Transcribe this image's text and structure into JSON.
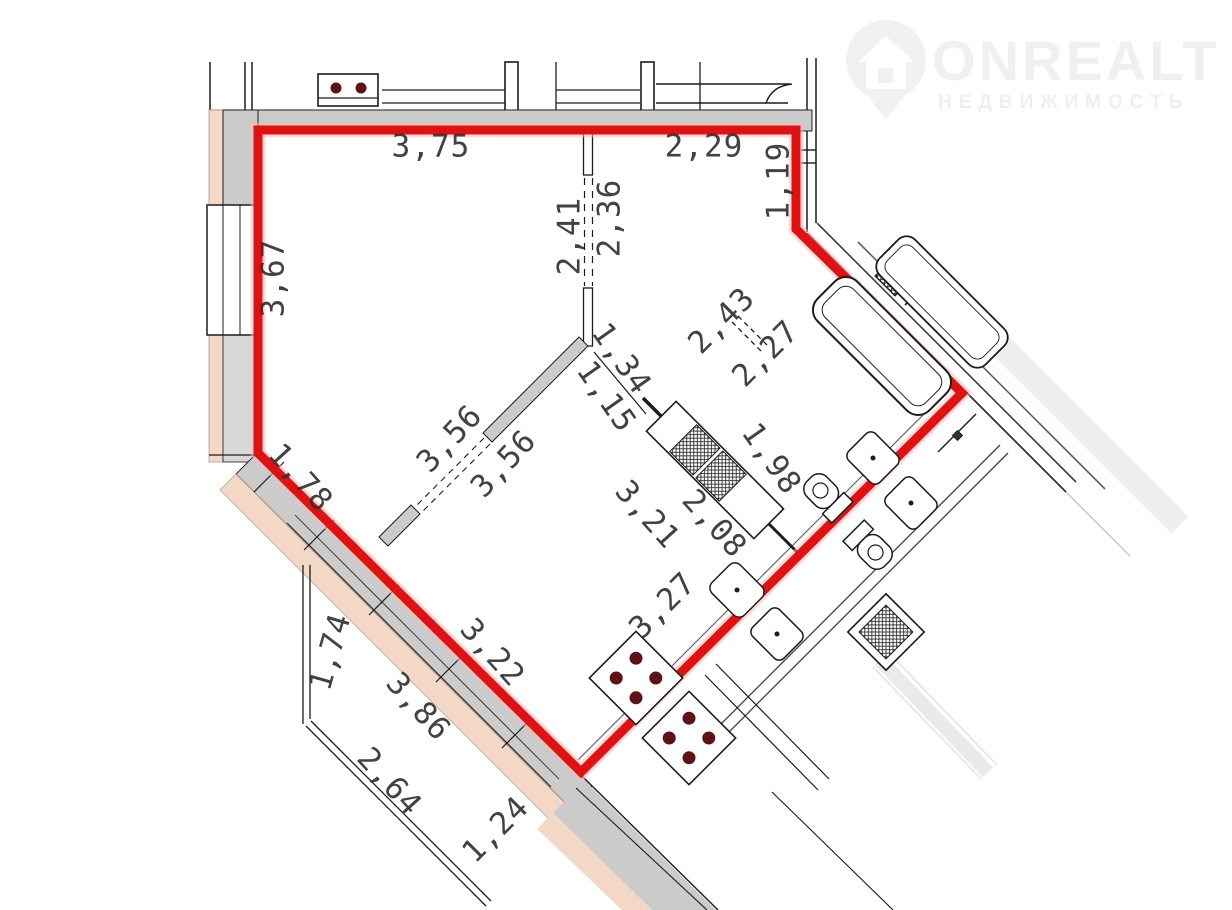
{
  "watermark": {
    "icon": "house-pin-icon",
    "brand": "ONREALT",
    "tagline": "НЕДВИЖИМОСТЬ"
  },
  "plan": {
    "type": "apartment-floor-plan",
    "unit_outline_color": "#e11111",
    "wall_fill_color": "#cbcbcb",
    "facade_fill_color": "#f3d8c6",
    "dimension_text_color": "#2e2e2e",
    "fixture_icons": {
      "bathtub-icon": "rounded rectangle",
      "toilet-icon": "bowl with tank",
      "sink-icon": "rounded square with dot",
      "stove-icon": "square with 4 burner dots",
      "vent-icon": "crosshatched square",
      "washing-machine-icon": "hatched square"
    },
    "dimensions": [
      {
        "id": "top-room-width",
        "value": "3,75"
      },
      {
        "id": "top-hall-width",
        "value": "2,29"
      },
      {
        "id": "right-niche",
        "value": "1,19"
      },
      {
        "id": "hall-depth-left",
        "value": "2,41"
      },
      {
        "id": "hall-depth-right",
        "value": "2,36"
      },
      {
        "id": "left-wall",
        "value": "3,67"
      },
      {
        "id": "partition-upper",
        "value": "3,56"
      },
      {
        "id": "partition-lower",
        "value": "3,56"
      },
      {
        "id": "left-diagonal",
        "value": "1,78"
      },
      {
        "id": "opening-upper",
        "value": "1,34"
      },
      {
        "id": "opening-lower",
        "value": "1,15"
      },
      {
        "id": "corridor-upper",
        "value": "2,43"
      },
      {
        "id": "corridor-lower",
        "value": "2,27"
      },
      {
        "id": "bathroom-width",
        "value": "1,98"
      },
      {
        "id": "kitchen-depth-upper",
        "value": "3,21"
      },
      {
        "id": "kitchen-depth-lower",
        "value": "2,08"
      },
      {
        "id": "kitchen-edge",
        "value": "3,27"
      },
      {
        "id": "balcony-side",
        "value": "1,74"
      },
      {
        "id": "facade-diag-upper",
        "value": "3,22"
      },
      {
        "id": "facade-diag-lower",
        "value": "3,86"
      },
      {
        "id": "balcony-edge-long",
        "value": "2,64"
      },
      {
        "id": "balcony-edge-short",
        "value": "1,24"
      }
    ]
  }
}
